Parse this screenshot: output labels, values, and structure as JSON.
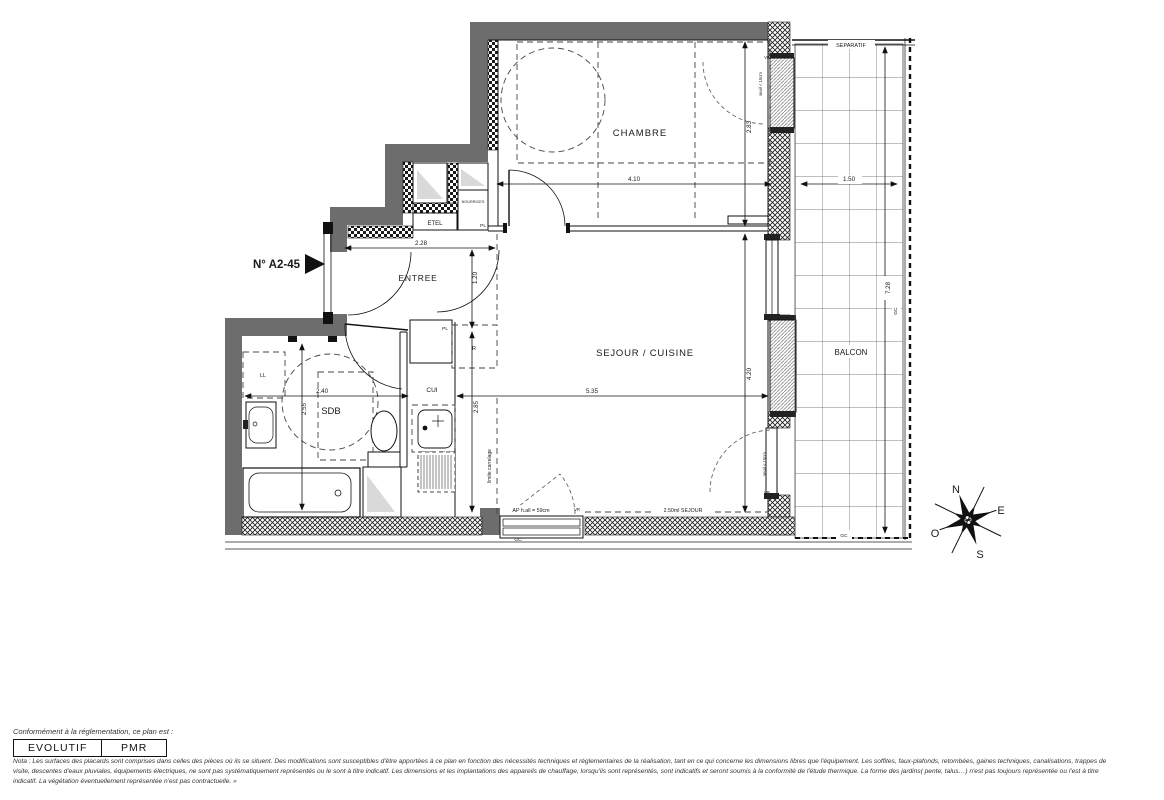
{
  "plan": {
    "unit": "N° A2-45",
    "rooms": {
      "chambre": "CHAMBRE",
      "entree": "ENTREE",
      "sejour_cuisine": "SEJOUR / CUISINE",
      "sdb": "SDB",
      "balcon": "BALCON"
    },
    "labels": {
      "etel": "ETEL",
      "nourrices": "NOURRICES",
      "pl_haut": "PL",
      "pl_cuisine": "PL",
      "refrigerateur": "R",
      "cui": "CUI",
      "lave_linge": "LL",
      "vr_chambre": "VR",
      "vr_sejour": "VR",
      "vr_fenetre": "VR",
      "seuil_chambre": "seuil < 15cm",
      "seuil_sejour": "seuil < 15cm",
      "separatif": "SEPARATIF",
      "gc_fenetre": "GC",
      "gc_droit": "GC",
      "gc_bas": "GC",
      "limite_carrelage": "limite carrelage",
      "allege": "AP h.all = 59cm",
      "lineaire_sejour": "2.50ml SEJOUR"
    },
    "dims": {
      "chambre_l": "4.10",
      "balcon_l": "1.50",
      "chambre_p": "2.83",
      "sejour_p": "4.20",
      "entree_l": "2.28",
      "entree_p": "1.20",
      "sdb_l": "2.40",
      "sejour_l": "5.35",
      "cuisine_p": "2.85",
      "sdb_p": "2.55",
      "balcon_p": "7.28"
    },
    "compass": {
      "n": "N",
      "e": "E",
      "s": "S",
      "o": "O"
    }
  },
  "legend": {
    "intro": "Conformément à la réglementation, ce plan est :",
    "badge1": "EVOLUTIF",
    "badge2": "PMR"
  },
  "nota": {
    "line1": "Nota : Les surfaces des placards sont comprises dans celles des pièces où ils se situent. Des modifications sont susceptibles d'être apportées à ce plan en fonction des nécessités techniques et réglementaires de la réalisation, tant en ce qui concerne les dimensions libres que l'équipement.  Les soffites, faux-plafonds, retombées, gaines techniques, canalisations, trappes de",
    "line2": "visite, descentes d'eaux pluviales, équipements électriques, ne sont pas systématiquement représentés ou le sont à titre indicatif. Les dimensions et les implantations des appareils de chauffage, lorsqu'ils sont représentés, sont indicatifs et seront soumis à la conformité de l'étude thermique. La forme des jardins( pente, talus…) n'est pas toujours représentée ou l'est à titre",
    "line3": "indicatif. La végétation éventuellement représentée n'est pas contractuelle. »"
  }
}
